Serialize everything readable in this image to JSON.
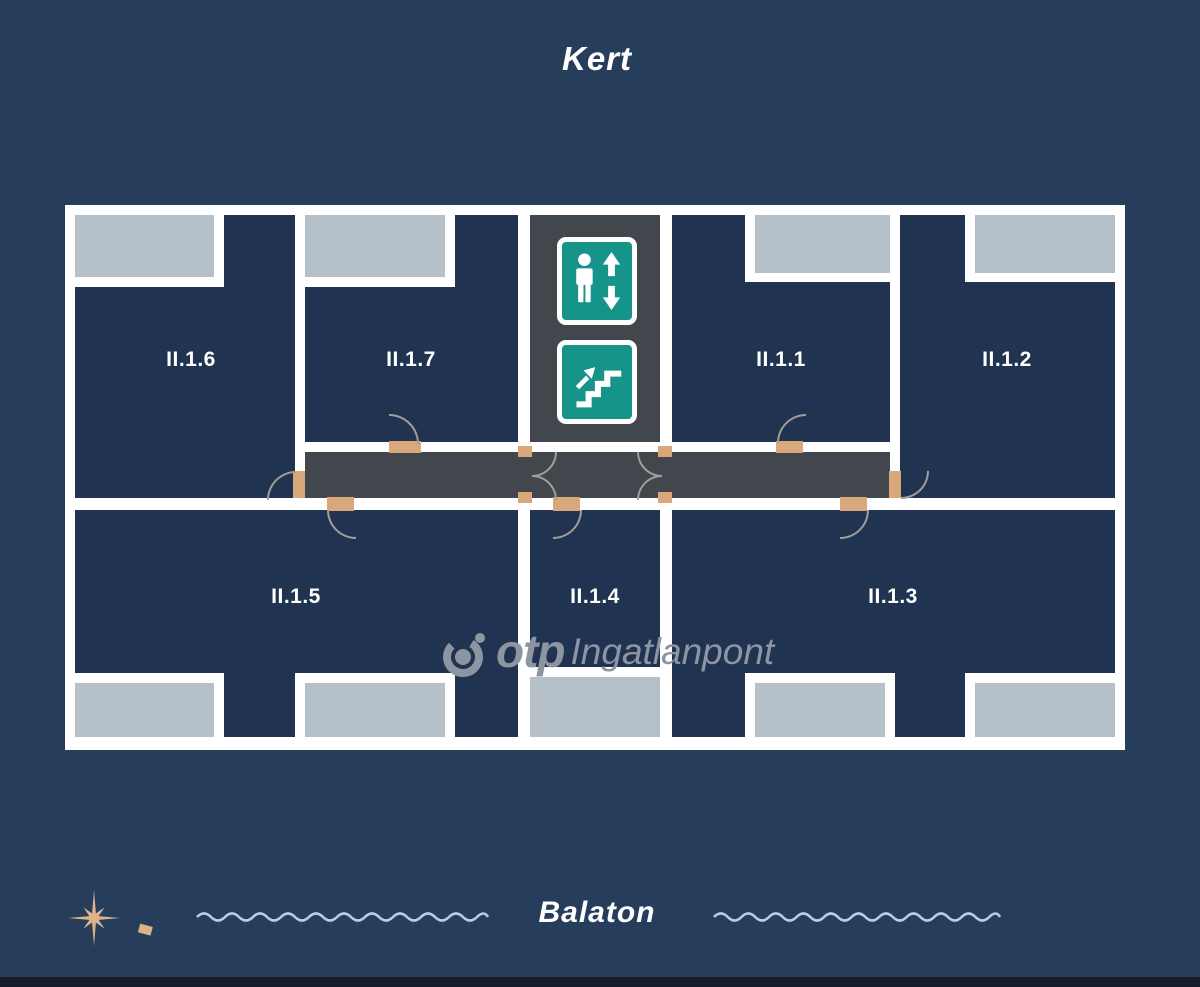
{
  "labels": {
    "garden": "Kert",
    "lake": "Balaton"
  },
  "units": {
    "u1": "II.1.1",
    "u2": "II.1.2",
    "u3": "II.1.3",
    "u4": "II.1.4",
    "u5": "II.1.5",
    "u6": "II.1.6",
    "u7": "II.1.7"
  },
  "watermark": {
    "brand": "otp",
    "suffix": "Ingatlanpont"
  },
  "icons": {
    "elevator": "elevator-sign",
    "stairs": "stairs-up-sign",
    "compass": "compass-rose",
    "waves": "water-wave-line"
  },
  "colors": {
    "background": "#263d5c",
    "wall_white": "#ffffff",
    "room_navy": "#203451",
    "corridor_gray": "#42464d",
    "balcony_gray": "#b6c0c9",
    "sign_teal": "#17948a",
    "door_tan": "#d9a87a",
    "door_arc": "#a39d98",
    "watermark_gray": "#8d95a2",
    "wave_blue": "#b9cce9",
    "compass_tan": "#dfb38a",
    "bottom_bar": "#161e2e"
  }
}
